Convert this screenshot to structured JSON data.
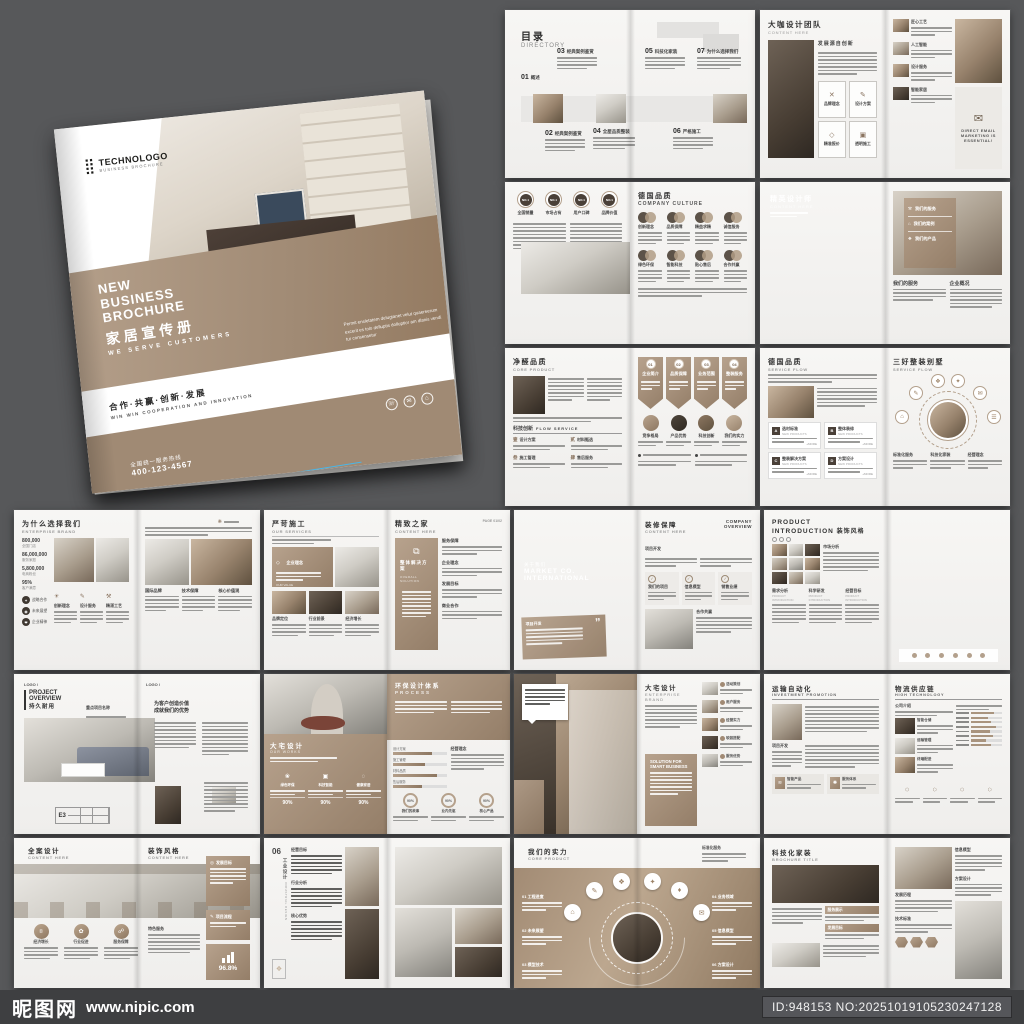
{
  "watermark": {
    "site_name": "昵图网",
    "site_url": "www.nipic.com",
    "id_text": "ID:948153 NO:20251019105230247128"
  },
  "cover": {
    "logo_text": "TECHNOLOGO",
    "logo_sub": "BUSINESS BROCHURE",
    "title_l1": "NEW",
    "title_l2": "BUSINESS",
    "title_l3": "BROCHURE",
    "title_cn": "家居宣传册",
    "subtitle_en": "WE SERVE CUSTOMERS",
    "body_text": "Permit ensletatem delugtanet velut quaereerum excerit es tolo delluptis dolluptior am dlanis vendi tur consensetur",
    "slogan_cn": "合作·共赢·创新·发展",
    "slogan_en": "WIN WIN COOPERATION AND INNOVATION",
    "hotline_label": "全国统一服务热线",
    "hotline_number": "400-123-4567"
  },
  "directory": {
    "title_cn": "目录",
    "title_en": "DIRECTORY",
    "items": [
      {
        "num": "01",
        "label": "概述"
      },
      {
        "num": "02",
        "label": "经典案例鉴赏"
      },
      {
        "num": "03",
        "label": "经典案例鉴赏"
      },
      {
        "num": "04",
        "label": "全屋品质整装"
      },
      {
        "num": "05",
        "label": "科技化家装"
      },
      {
        "num": "06",
        "label": "严格施工"
      },
      {
        "num": "07",
        "label": "为什么选择我们"
      }
    ]
  },
  "team": {
    "title_cn": "大咖设计团队",
    "title_en": "CONTENT HERE",
    "heading": "发展源自创新",
    "boxes": [
      {
        "label": "品牌理念"
      },
      {
        "label": "设计方案"
      },
      {
        "label": "精准报价"
      },
      {
        "label": "透明施工"
      }
    ],
    "list": [
      {
        "label": "匠心工艺"
      },
      {
        "label": "人工智能"
      },
      {
        "label": "设计服务"
      },
      {
        "label": "智能家居"
      }
    ],
    "promo_line1": "DIRECT EMAIL",
    "promo_line2": "MARKETING IS",
    "promo_line3": "ESSENTIAL!"
  },
  "culture": {
    "badge_rank": "NO.1",
    "badges": [
      "全国销量",
      "市场占有",
      "用户口碑",
      "品牌价值"
    ],
    "title_cn": "德国品质",
    "title_en": "COMPANY CULTURE",
    "items": [
      "创新理念",
      "品质保障",
      "精益求精",
      "诚信服务",
      "绿色环保",
      "智能科技",
      "贴心售后",
      "合作共赢"
    ]
  },
  "elite": {
    "title_cn": "精英设计师",
    "title_en": "CONTENT HERE",
    "overlay_items": [
      "我们的服务",
      "我们的案例",
      "我们的产品"
    ],
    "col1": "我们的服务",
    "col2": "企业概况"
  },
  "core": {
    "title_cn": "净醛品质",
    "title_en": "CORE PRODUCT",
    "flow_cn": "科技创新",
    "flow_en": "FLOW SERVICE",
    "flow_items": [
      {
        "num": "壹",
        "label": "设计方案"
      },
      {
        "num": "贰",
        "label": "材料甄选"
      },
      {
        "num": "叁",
        "label": "施工管理"
      },
      {
        "num": "肆",
        "label": "售后服务"
      }
    ],
    "banners": [
      {
        "num": "01",
        "label": "企业简介"
      },
      {
        "num": "02",
        "label": "品质保障"
      },
      {
        "num": "03",
        "label": "业务范围"
      },
      {
        "num": "04",
        "label": "整装服务"
      }
    ],
    "circles": [
      "竞争格局",
      "产品优势",
      "科技创新",
      "我们的实力"
    ]
  },
  "flow": {
    "left_cn": "德国品质",
    "left_en": "SERVICE FLOW",
    "boxes": [
      {
        "tag": "A",
        "label": "选材标准"
      },
      {
        "tag": "B",
        "label": "整体装修"
      },
      {
        "tag": "C",
        "label": "整装解决方案"
      },
      {
        "tag": "D",
        "label": "方案设计"
      }
    ],
    "box_sub": "NEW PRODUCTS",
    "more": "+MORE",
    "right_cn": "三好整装别墅",
    "right_en": "SERVICE FLOW",
    "cols": [
      "标准化服务",
      "科技化家装",
      "经营理念"
    ]
  },
  "whyus": {
    "title_cn": "为什么选择我们",
    "title_en": "ENTERPRISE BRAND",
    "stats": [
      {
        "value": "800,000",
        "label": "全国门店"
      },
      {
        "value": "86,000,000",
        "label": "服务家庭"
      },
      {
        "value": "5,800,000",
        "label": "电商粉丝"
      },
      {
        "value": "95%",
        "label": "客户满意"
      }
    ],
    "icon_cols": [
      "创新理念",
      "设计服务",
      "精湛工艺"
    ],
    "side_circles": [
      "战略合作",
      "未来展望",
      "企业精神"
    ],
    "right_sections": [
      "国际品牌",
      "技术保障",
      "核心价值观"
    ]
  },
  "services": {
    "title_cn": "严苛施工",
    "title_en": "OUR SERVICES",
    "card_label": "企业理念",
    "card_sub": "OUR VALUE",
    "photo_labels": [
      "品牌定位",
      "行业前景",
      "经济增长"
    ],
    "right_cn": "精致之家",
    "right_en": "CONTENT HERE",
    "page": "PAGE 01/02",
    "panel_label": "整体解决方案",
    "panel_sub": "OVERALL SOLUTION",
    "sections": [
      "服务保障",
      "企业理念",
      "发展目标",
      "商业合作"
    ]
  },
  "market": {
    "about_cn": "关于我们",
    "co_l1": "MARKET CO.",
    "co_l2": "INTERNATIONAL",
    "quote_label": "项目开发",
    "title_cn": "装修保障",
    "title_en": "CONTENT HERE",
    "overview": "COMPANY OVERVIEW",
    "section": "项目开发",
    "boxes": [
      "我们的项目",
      "信息模型",
      "销售业绩"
    ],
    "bottom_label": "合作共赢"
  },
  "intro": {
    "title_l1": "PRODUCT",
    "title_l2": "INTRODUCTION",
    "title_cn": "装饰风格",
    "section": "市场分析",
    "cols": [
      {
        "label": "需求分析",
        "sub": "PRODUCT INTRODUCTION"
      },
      {
        "label": "科学研发",
        "sub": "PRODUCT INTRODUCTION"
      },
      {
        "label": "经营目标",
        "sub": "PRODUCT INTRODUCTION"
      }
    ]
  },
  "overview": {
    "logo": "LOGO /",
    "title_l1": "PROJECT",
    "title_l2": "OVERVIEW",
    "title_cn": "持久耐用",
    "project_label": "重点项目名称",
    "table_tag": "E3",
    "heading_l1": "为客户创造价值",
    "heading_l2": "成就我们的优势"
  },
  "process": {
    "left_cn": "大宅设计",
    "left_en": "OUR WORKS",
    "left_cols": [
      {
        "label": "绿色环保",
        "value": "90%"
      },
      {
        "label": "科技智能",
        "value": "90%"
      },
      {
        "label": "健康家居",
        "value": "90%"
      }
    ],
    "right_cn": "环保设计体系",
    "right_en": "PROCESS",
    "bars": [
      "设计方案",
      "施工管理",
      "材料品质",
      "售后服务"
    ],
    "bars_heading": "经营理念",
    "donuts": [
      {
        "value": "90%",
        "label": "我们的故事"
      },
      {
        "value": "90%",
        "label": "业内先驱"
      },
      {
        "value": "90%",
        "label": "核心产品"
      }
    ]
  },
  "brand": {
    "title_cn": "大宅设计",
    "title_l1": "ENTERPRISE",
    "title_l2": "BRAND",
    "panel_l1": "SOLUTION FOR",
    "panel_l2": "SMART BUSINESS",
    "items": [
      "活动策划",
      "用户服务",
      "经营实力",
      "软装搭配",
      "服务优势"
    ]
  },
  "logistics": {
    "title_cn": "运输自动化",
    "title_en": "INVESTMENT PROMOTION",
    "section": "项目开发",
    "boxes": [
      "智能产品",
      "服务体系"
    ],
    "right_cn": "物流供应链",
    "right_en": "HIGH TECHNOLOGY",
    "intro_label": "公司介绍",
    "rows": [
      "智能仓储",
      "运输管理",
      "终端配送"
    ]
  },
  "fullcase": {
    "left_cn": "全案设计",
    "left_en": "CONTENT HERE",
    "right_cn": "装饰风格",
    "right_en": "CONTENT HERE",
    "circles": [
      "经济增长",
      "行业促进",
      "服务保障"
    ],
    "section": "特色服务",
    "panels": [
      "发展目标",
      "项目流程"
    ],
    "stat": "96.8%"
  },
  "industrial": {
    "num": "06",
    "side_cn": "工业设计",
    "side_en": "INDUSTRIAL DESIGN",
    "sections": [
      "经营目标",
      "行业分析",
      "核心优势"
    ]
  },
  "strength": {
    "title_cn": "我们的实力",
    "title_en": "CORE PRODUCT",
    "corner_label": "标准化服务",
    "left_items": [
      {
        "num": "01",
        "label": "工程进度"
      },
      {
        "num": "02",
        "label": "未来展望"
      },
      {
        "num": "03",
        "label": "模型技术"
      }
    ],
    "right_items": [
      {
        "num": "04",
        "label": "业务领域"
      },
      {
        "num": "05",
        "label": "信息模型"
      },
      {
        "num": "06",
        "label": "方案设计"
      }
    ]
  },
  "tech": {
    "title_cn": "科技化家装",
    "title_en": "BROCHURE TITLE",
    "bars": [
      "服务展示",
      "发展目标"
    ],
    "sections": [
      "发展历程",
      "技术标准"
    ],
    "col_sections": [
      "信息模型",
      "方案设计"
    ]
  }
}
